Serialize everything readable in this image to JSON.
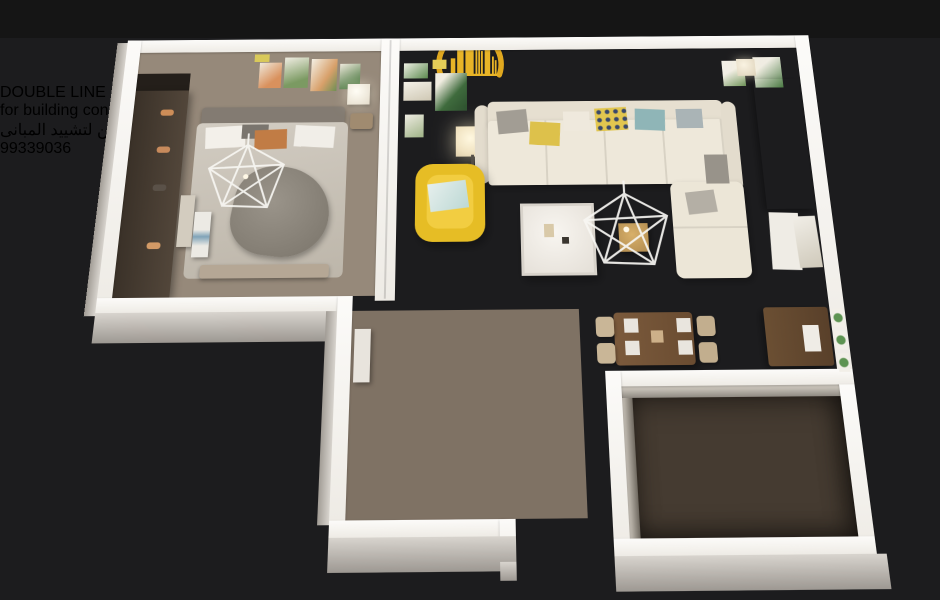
{
  "branding": {
    "company": "DOUBLE LINE",
    "tagline": "for building construction",
    "arabic_name": "دبل لاين لتشييد المبانى",
    "phone": "99339036"
  },
  "watermark": "www.kuwait-home.com",
  "palette": {
    "background": "#1c1c1e",
    "brand_gold": "#e9b42e",
    "badge_red": "#d6352e",
    "wall_white": "#f8f6f2",
    "floor_wood_light": "#96897a",
    "floor_wood_dark": "#453b31",
    "accent_armchair_yellow": "#e6bd25",
    "accent_rug_teal": "#4d95a6",
    "accent_rug_navy": "#2f4158",
    "accent_rug_mauve": "#a77986",
    "dining_rug_red": "#b23a2e"
  }
}
